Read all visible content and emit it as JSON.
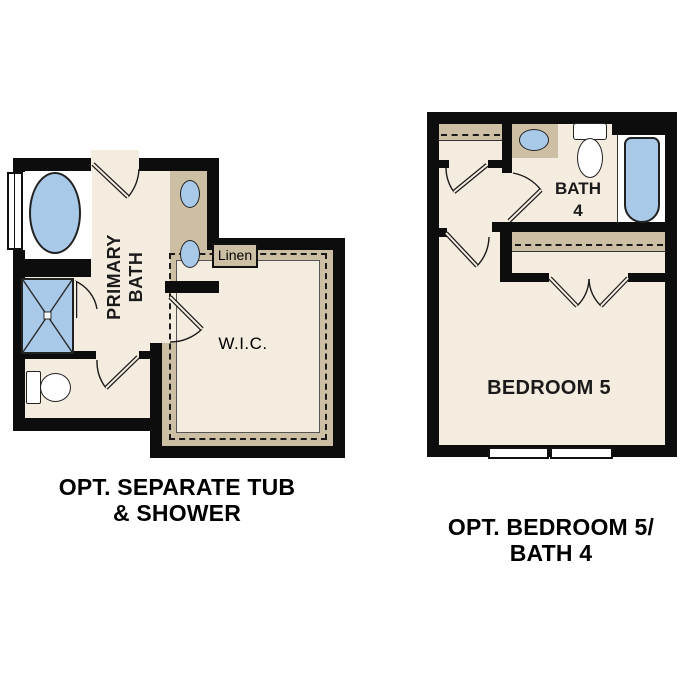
{
  "figure_type": "floor-plan-options-diagram",
  "plans": {
    "left": {
      "caption_line1": "OPT. SEPARATE TUB",
      "caption_line2": "& SHOWER",
      "rooms": {
        "primary_bath": {
          "label_line1": "PRIMARY",
          "label_line2": "BATH"
        },
        "wic": {
          "label": "W.I.C."
        },
        "linen": {
          "label": "Linen"
        }
      },
      "fixtures": [
        "separate-tub",
        "shower",
        "toilet",
        "double-sink-vanity",
        "window",
        "linen-closet",
        "walk-in-closet-shelving"
      ]
    },
    "right": {
      "caption_line1": "OPT. BEDROOM 5/",
      "caption_line2": "BATH 4",
      "rooms": {
        "bath4": {
          "label_line1": "BATH",
          "label_line2": "4"
        },
        "bedroom5": {
          "label": "BEDROOM 5"
        }
      },
      "fixtures": [
        "tub",
        "toilet",
        "sink-vanity",
        "window",
        "reach-in-closet",
        "hall-closet"
      ]
    }
  },
  "colors": {
    "wall": "#0d0d0d",
    "floor": "#f4ecdf",
    "shelf": "#cdbfa4",
    "fixture": "#a9c9e8",
    "bg": "#ffffff"
  }
}
